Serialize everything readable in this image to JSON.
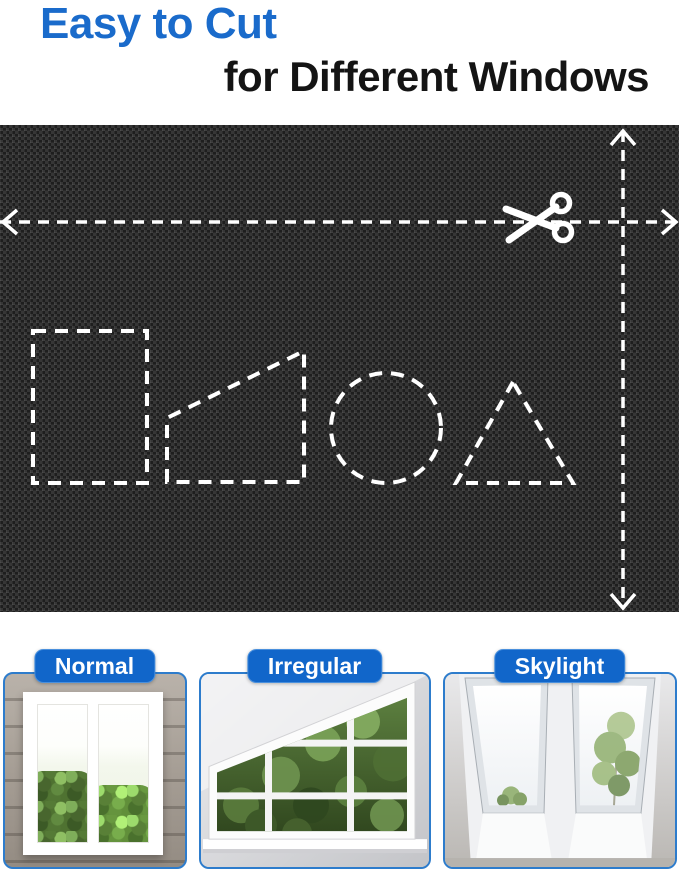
{
  "title": {
    "line1": "Easy to Cut",
    "line2": "for Different Windows"
  },
  "colors": {
    "title_blue": "#1a6bcb",
    "text_black": "#141414",
    "pill_blue": "#1166ca",
    "panel_border": "#2d7ccc",
    "cut_line_white": "#ffffff",
    "fabric_base": "#1d1d1d"
  },
  "fabric_overlay": {
    "description": "dashed cutting guides on blackout fabric",
    "elements": [
      {
        "name": "horizontal-cut-line",
        "el": "line",
        "x1": 0,
        "y1": 97,
        "x2": 679,
        "y2": 97,
        "dash": "11 8",
        "w": 3.5
      },
      {
        "name": "left-arrowhead",
        "el": "polyline",
        "points": "17,85 3,97 17,109",
        "w": 3.5
      },
      {
        "name": "right-arrowhead",
        "el": "polyline",
        "points": "662,85 676,97 662,109",
        "w": 3.5
      },
      {
        "name": "vertical-cut-line",
        "el": "line",
        "x1": 623,
        "y1": 6,
        "x2": 623,
        "y2": 483,
        "dash": "11 8",
        "w": 3.5
      },
      {
        "name": "top-arrowhead",
        "el": "polyline",
        "points": "611,20 623,6 635,20",
        "w": 3.5
      },
      {
        "name": "bottom-arrowhead",
        "el": "polyline",
        "points": "611,469 623,483 635,469",
        "w": 3.5
      },
      {
        "name": "rectangle-cutout",
        "el": "rect",
        "x": 33,
        "y": 206,
        "width": 114,
        "height": 152,
        "dash": "13 9",
        "w": 4
      },
      {
        "name": "trapezoid-cutout",
        "el": "polygon",
        "points": "167,357 167,293 304,226 304,357",
        "dash": "13 9",
        "w": 4
      },
      {
        "name": "circle-cutout",
        "el": "circle",
        "cx": 386,
        "cy": 303,
        "r": 55,
        "dash": "13 9",
        "w": 4
      },
      {
        "name": "triangle-cutout",
        "el": "polygon",
        "points": "513,257 456,358 573,358",
        "dash": "12 9",
        "w": 4
      },
      {
        "name": "scissors-icon-blade",
        "el": "line",
        "x1": 506,
        "y1": 84,
        "x2": 556,
        "y2": 103,
        "w": 7,
        "cap": "round"
      },
      {
        "name": "scissors-icon-blade",
        "el": "line",
        "x1": 509,
        "y1": 115,
        "x2": 556,
        "y2": 82,
        "w": 7,
        "cap": "round"
      },
      {
        "name": "scissors-icon-handle",
        "el": "circle",
        "cx": 563,
        "cy": 107,
        "r": 8.5,
        "w": 5.5
      },
      {
        "name": "scissors-icon-handle",
        "el": "circle",
        "cx": 561,
        "cy": 78,
        "r": 8.5,
        "w": 5.5
      }
    ]
  },
  "panels": [
    {
      "id": "normal",
      "label": "Normal"
    },
    {
      "id": "irregular",
      "label": "Irregular"
    },
    {
      "id": "skylight",
      "label": "Skylight"
    }
  ]
}
